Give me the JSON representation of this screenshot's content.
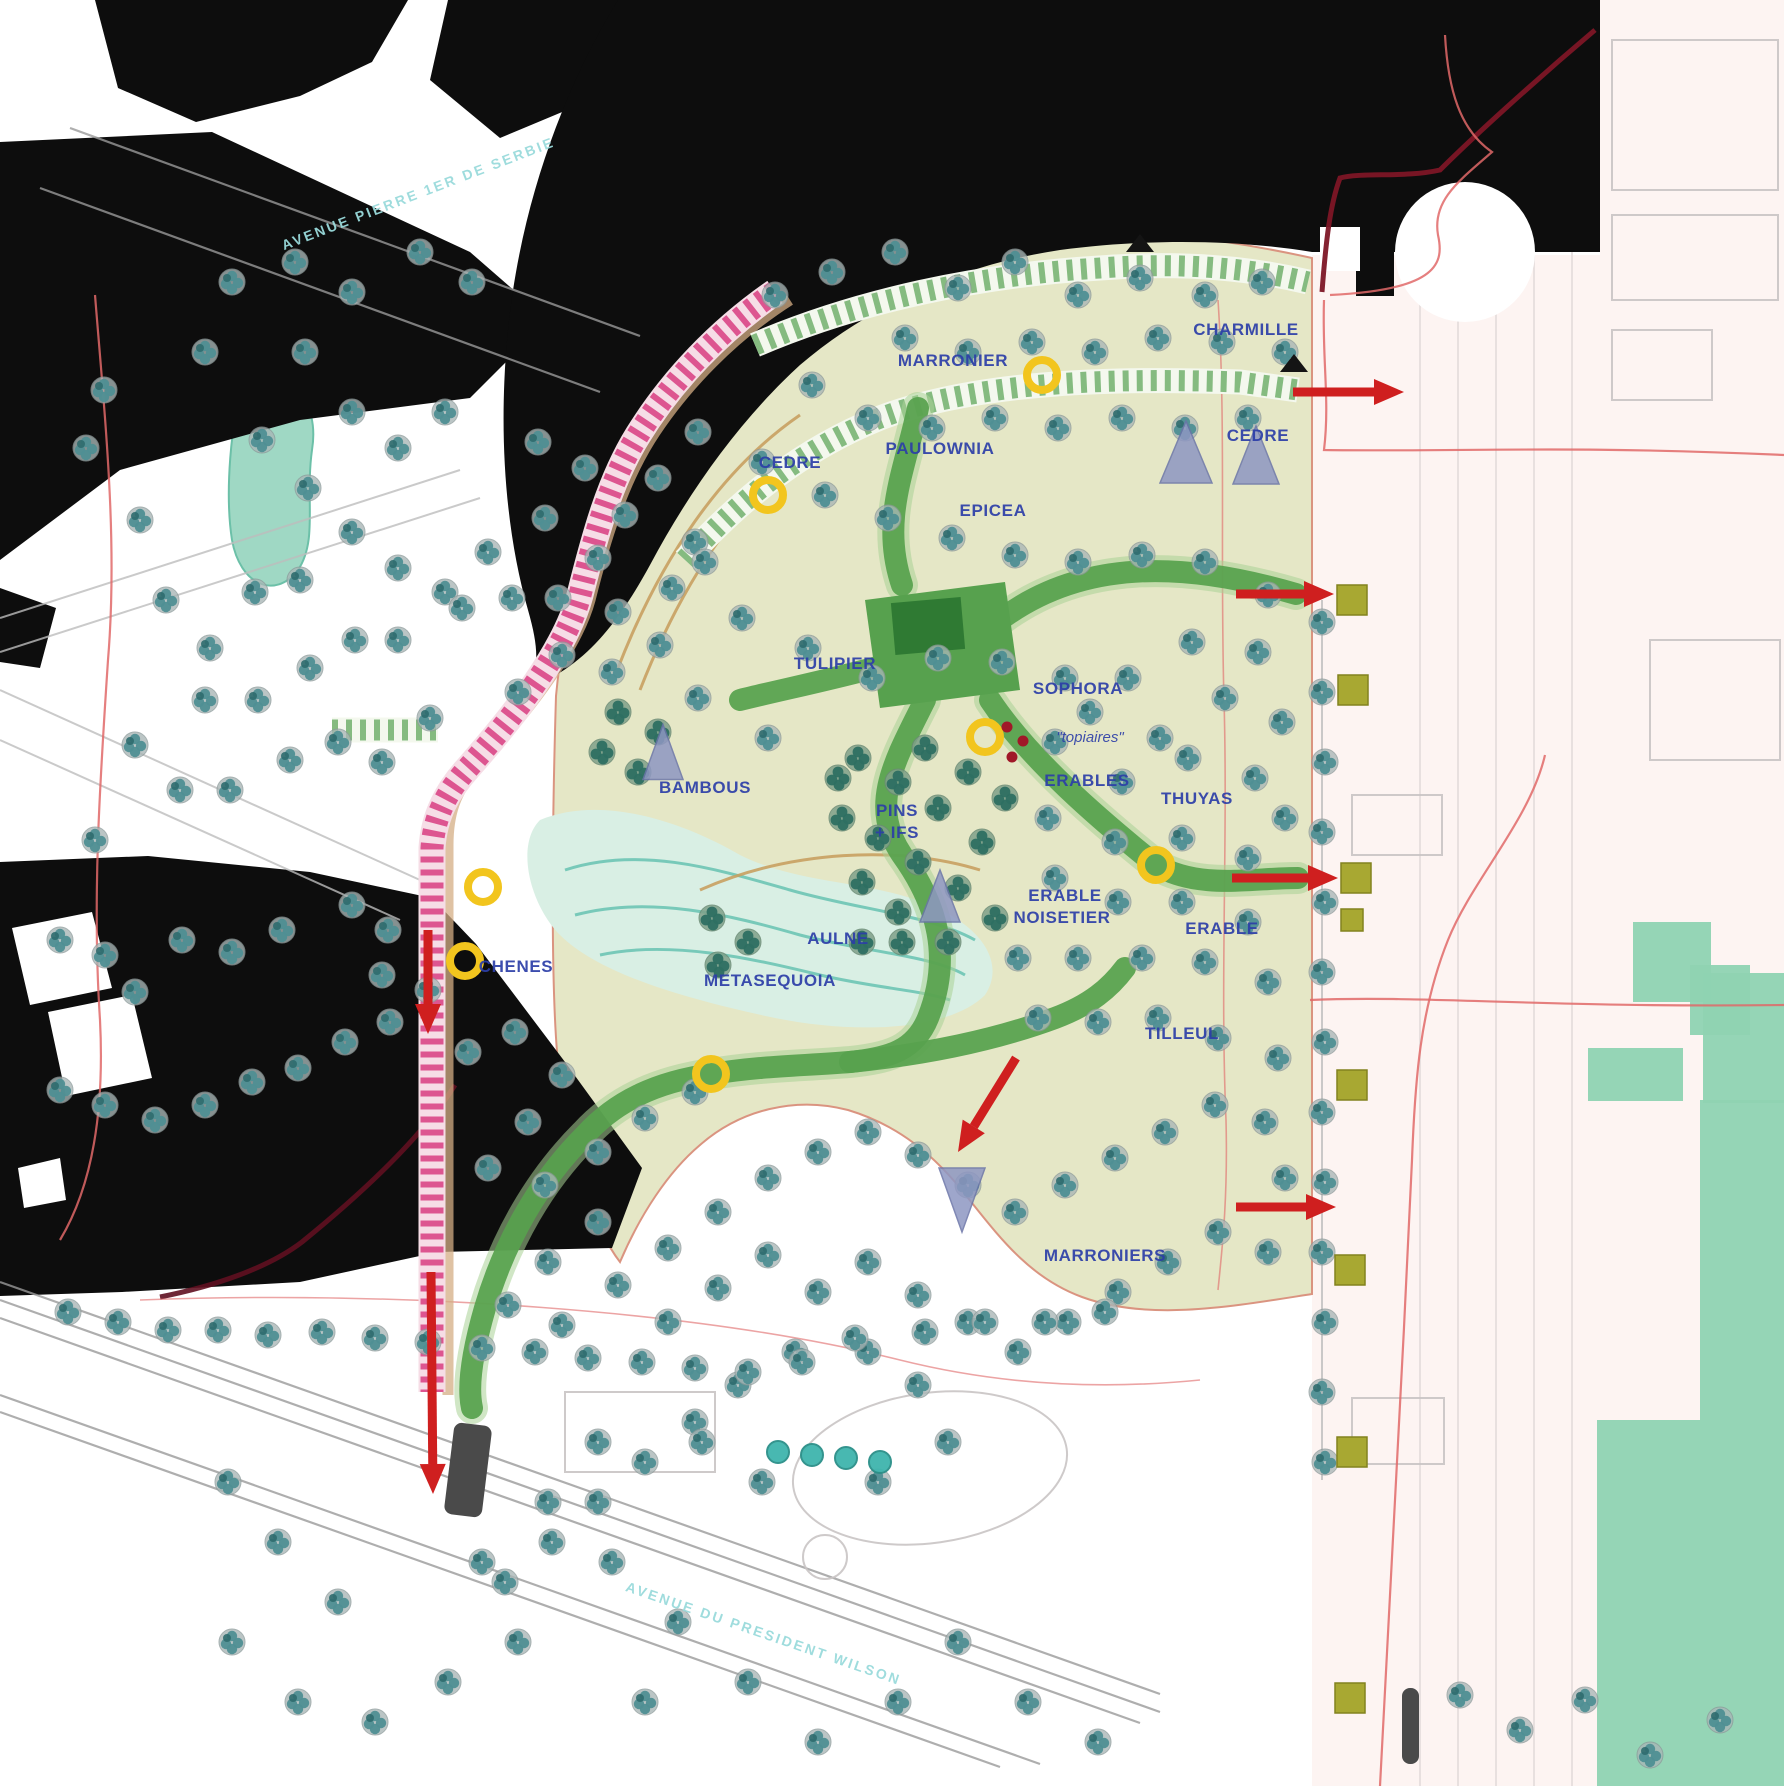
{
  "map_type": "landscape-masterplan",
  "colors": {
    "path_pink": "#dd5590",
    "hedge_green": "#85bb80",
    "walk_green": "#57a14e",
    "marker_yellow": "#f2c51e",
    "arrow_red": "#cf1f1f",
    "label_blue": "#2c3ea8",
    "street_cyan": "#9adbdc",
    "lawn_beige": "#e4e6c3",
    "block_teal": "#8fd3b2",
    "square_olive": "#a8a832",
    "building_black": "#0d0d0d"
  },
  "streets": [
    {
      "text": "AVENUE PIERRE 1ER DE SERBIE",
      "x": 420,
      "y": 198,
      "rot": -21
    },
    {
      "text": "AVENUE DU PRESIDENT WILSON",
      "x": 762,
      "y": 1638,
      "rot": 19
    }
  ],
  "plant_labels": [
    {
      "text": "MARRONIER",
      "x": 953,
      "y": 366
    },
    {
      "text": "CHARMILLE",
      "x": 1246,
      "y": 335
    },
    {
      "text": "PAULOWNIA",
      "x": 940,
      "y": 454
    },
    {
      "text": "CEDRE",
      "x": 790,
      "y": 468
    },
    {
      "text": "EPICEA",
      "x": 993,
      "y": 516
    },
    {
      "text": "CEDRE",
      "x": 1258,
      "y": 441
    },
    {
      "text": "TULIPIER",
      "x": 835,
      "y": 669
    },
    {
      "text": "SOPHORA",
      "x": 1078,
      "y": 694
    },
    {
      "text": "ERABLES",
      "x": 1087,
      "y": 786
    },
    {
      "text": "THUYAS",
      "x": 1197,
      "y": 804
    },
    {
      "text": "PINS",
      "x": 897,
      "y": 816
    },
    {
      "text": "+ IFS",
      "x": 897,
      "y": 838
    },
    {
      "text": "ERABLE",
      "x": 1065,
      "y": 901
    },
    {
      "text": "NOISETIER",
      "x": 1062,
      "y": 923
    },
    {
      "text": "ERABLE",
      "x": 1222,
      "y": 934
    },
    {
      "text": "AULNE",
      "x": 838,
      "y": 944
    },
    {
      "text": "METASEQUOIA",
      "x": 770,
      "y": 986
    },
    {
      "text": "TILLEUL",
      "x": 1182,
      "y": 1039
    },
    {
      "text": "BAMBOUS",
      "x": 705,
      "y": 793
    },
    {
      "text": "CHENES",
      "x": 516,
      "y": 972
    },
    {
      "text": "MARRONIERS",
      "x": 1105,
      "y": 1261
    }
  ],
  "annotations": [
    {
      "text": "\"topiaires\"",
      "x": 1090,
      "y": 742
    }
  ],
  "markers": {
    "yellow_circles": [
      [
        1042,
        375
      ],
      [
        768,
        495
      ],
      [
        985,
        737
      ],
      [
        1156,
        865
      ],
      [
        483,
        887
      ],
      [
        465,
        961
      ],
      [
        711,
        1074
      ]
    ],
    "red_dots": [
      [
        1007,
        727
      ],
      [
        1023,
        741
      ],
      [
        1012,
        757
      ]
    ],
    "red_arrows": [
      [
        1293,
        392,
        1404,
        392
      ],
      [
        1236,
        594,
        1334,
        594
      ],
      [
        1232,
        878,
        1338,
        878
      ],
      [
        1016,
        1058,
        958,
        1152
      ],
      [
        428,
        930,
        428,
        1034
      ],
      [
        431,
        1272,
        433,
        1494
      ],
      [
        1236,
        1207,
        1336,
        1207
      ]
    ],
    "black_triangles": [
      [
        1140,
        244
      ],
      [
        1294,
        364
      ]
    ],
    "gray_triangles": [
      [
        1186,
        452,
        52,
        62,
        0
      ],
      [
        1256,
        455,
        46,
        58,
        0
      ],
      [
        940,
        896,
        40,
        52,
        0
      ],
      [
        962,
        1200,
        46,
        64,
        180
      ],
      [
        663,
        752,
        40,
        55,
        0
      ]
    ],
    "olive_squares": [
      [
        1352,
        600,
        30
      ],
      [
        1353,
        690,
        30
      ],
      [
        1356,
        878,
        30
      ],
      [
        1352,
        920,
        22
      ],
      [
        1352,
        1085,
        30
      ],
      [
        1350,
        1270,
        30
      ],
      [
        1352,
        1452,
        30
      ],
      [
        1350,
        1698,
        30
      ]
    ],
    "dark_bars": [
      [
        449,
        1424,
        38,
        92,
        7
      ],
      [
        1402,
        1688,
        17,
        76,
        0
      ]
    ]
  },
  "trees": {
    "standard": [
      [
        232,
        282
      ],
      [
        295,
        262
      ],
      [
        352,
        292
      ],
      [
        420,
        252
      ],
      [
        472,
        282
      ],
      [
        205,
        352
      ],
      [
        104,
        390
      ],
      [
        86,
        448
      ],
      [
        140,
        520
      ],
      [
        166,
        600
      ],
      [
        210,
        648
      ],
      [
        262,
        440
      ],
      [
        305,
        352
      ],
      [
        352,
        412
      ],
      [
        398,
        448
      ],
      [
        445,
        412
      ],
      [
        308,
        488
      ],
      [
        352,
        532
      ],
      [
        398,
        568
      ],
      [
        300,
        580
      ],
      [
        255,
        592
      ],
      [
        205,
        700
      ],
      [
        258,
        700
      ],
      [
        310,
        668
      ],
      [
        355,
        640
      ],
      [
        398,
        640
      ],
      [
        445,
        592
      ],
      [
        488,
        552
      ],
      [
        135,
        745
      ],
      [
        180,
        790
      ],
      [
        230,
        790
      ],
      [
        95,
        840
      ],
      [
        290,
        760
      ],
      [
        338,
        742
      ],
      [
        382,
        762
      ],
      [
        430,
        718
      ],
      [
        60,
        940
      ],
      [
        105,
        955
      ],
      [
        388,
        930
      ],
      [
        352,
        905
      ],
      [
        282,
        930
      ],
      [
        232,
        952
      ],
      [
        182,
        940
      ],
      [
        135,
        992
      ],
      [
        382,
        975
      ],
      [
        428,
        990
      ],
      [
        60,
        1090
      ],
      [
        105,
        1105
      ],
      [
        155,
        1120
      ],
      [
        205,
        1105
      ],
      [
        252,
        1082
      ],
      [
        298,
        1068
      ],
      [
        345,
        1042
      ],
      [
        390,
        1022
      ],
      [
        538,
        442
      ],
      [
        585,
        468
      ],
      [
        625,
        515
      ],
      [
        598,
        558
      ],
      [
        558,
        598
      ],
      [
        618,
        612
      ],
      [
        672,
        588
      ],
      [
        695,
        542
      ],
      [
        658,
        478
      ],
      [
        698,
        432
      ],
      [
        545,
        518
      ],
      [
        512,
        598
      ],
      [
        562,
        655
      ],
      [
        612,
        672
      ],
      [
        660,
        645
      ],
      [
        518,
        692
      ],
      [
        462,
        608
      ],
      [
        775,
        295
      ],
      [
        832,
        272
      ],
      [
        895,
        252
      ],
      [
        958,
        288
      ],
      [
        1015,
        262
      ],
      [
        1078,
        295
      ],
      [
        1140,
        278
      ],
      [
        1205,
        295
      ],
      [
        1262,
        282
      ],
      [
        905,
        338
      ],
      [
        968,
        352
      ],
      [
        1032,
        342
      ],
      [
        1095,
        352
      ],
      [
        1158,
        338
      ],
      [
        1222,
        342
      ],
      [
        1285,
        352
      ],
      [
        812,
        385
      ],
      [
        868,
        418
      ],
      [
        932,
        428
      ],
      [
        995,
        418
      ],
      [
        1058,
        428
      ],
      [
        1122,
        418
      ],
      [
        1185,
        428
      ],
      [
        1248,
        418
      ],
      [
        762,
        462
      ],
      [
        825,
        495
      ],
      [
        888,
        518
      ],
      [
        952,
        538
      ],
      [
        1015,
        555
      ],
      [
        1078,
        562
      ],
      [
        1142,
        555
      ],
      [
        1205,
        562
      ],
      [
        1268,
        595
      ],
      [
        705,
        562
      ],
      [
        742,
        618
      ],
      [
        808,
        648
      ],
      [
        872,
        678
      ],
      [
        938,
        658
      ],
      [
        1002,
        662
      ],
      [
        1065,
        678
      ],
      [
        1128,
        678
      ],
      [
        1192,
        642
      ],
      [
        1258,
        652
      ],
      [
        698,
        698
      ],
      [
        768,
        738
      ],
      [
        1160,
        738
      ],
      [
        1225,
        698
      ],
      [
        1282,
        722
      ],
      [
        1090,
        712
      ],
      [
        1055,
        742
      ],
      [
        1122,
        782
      ],
      [
        1188,
        758
      ],
      [
        1255,
        778
      ],
      [
        1048,
        818
      ],
      [
        1115,
        842
      ],
      [
        1182,
        838
      ],
      [
        1248,
        858
      ],
      [
        1285,
        818
      ],
      [
        1055,
        878
      ],
      [
        1118,
        902
      ],
      [
        1182,
        902
      ],
      [
        1248,
        922
      ],
      [
        1018,
        958
      ],
      [
        1078,
        958
      ],
      [
        1142,
        958
      ],
      [
        1205,
        962
      ],
      [
        1268,
        982
      ],
      [
        1038,
        1018
      ],
      [
        1098,
        1022
      ],
      [
        1158,
        1018
      ],
      [
        1218,
        1038
      ],
      [
        1278,
        1058
      ],
      [
        468,
        1052
      ],
      [
        515,
        1032
      ],
      [
        562,
        1075
      ],
      [
        528,
        1122
      ],
      [
        488,
        1168
      ],
      [
        545,
        1185
      ],
      [
        598,
        1152
      ],
      [
        645,
        1118
      ],
      [
        695,
        1092
      ],
      [
        598,
        1222
      ],
      [
        548,
        1262
      ],
      [
        508,
        1305
      ],
      [
        562,
        1325
      ],
      [
        618,
        1285
      ],
      [
        668,
        1248
      ],
      [
        718,
        1212
      ],
      [
        768,
        1178
      ],
      [
        818,
        1152
      ],
      [
        868,
        1132
      ],
      [
        918,
        1155
      ],
      [
        968,
        1185
      ],
      [
        1015,
        1212
      ],
      [
        1065,
        1185
      ],
      [
        1115,
        1158
      ],
      [
        1165,
        1132
      ],
      [
        1215,
        1105
      ],
      [
        1265,
        1122
      ],
      [
        1285,
        1178
      ],
      [
        668,
        1322
      ],
      [
        718,
        1288
      ],
      [
        768,
        1255
      ],
      [
        818,
        1292
      ],
      [
        868,
        1262
      ],
      [
        918,
        1295
      ],
      [
        968,
        1322
      ],
      [
        1018,
        1352
      ],
      [
        1068,
        1322
      ],
      [
        1118,
        1292
      ],
      [
        1168,
        1262
      ],
      [
        1218,
        1232
      ],
      [
        1268,
        1252
      ],
      [
        868,
        1352
      ],
      [
        918,
        1385
      ],
      [
        795,
        1352
      ],
      [
        738,
        1385
      ],
      [
        695,
        1422
      ],
      [
        645,
        1462
      ],
      [
        598,
        1502
      ],
      [
        552,
        1542
      ],
      [
        505,
        1582
      ],
      [
        1322,
        622
      ],
      [
        1322,
        692
      ],
      [
        1325,
        762
      ],
      [
        1322,
        832
      ],
      [
        1325,
        902
      ],
      [
        1322,
        972
      ],
      [
        1325,
        1042
      ],
      [
        1322,
        1112
      ],
      [
        1325,
        1182
      ],
      [
        1322,
        1252
      ],
      [
        1325,
        1322
      ],
      [
        1322,
        1392
      ],
      [
        1325,
        1462
      ],
      [
        68,
        1312
      ],
      [
        118,
        1322
      ],
      [
        168,
        1330
      ],
      [
        218,
        1330
      ],
      [
        268,
        1335
      ],
      [
        322,
        1332
      ],
      [
        375,
        1338
      ],
      [
        428,
        1342
      ],
      [
        482,
        1348
      ],
      [
        535,
        1352
      ],
      [
        588,
        1358
      ],
      [
        642,
        1362
      ],
      [
        695,
        1368
      ],
      [
        748,
        1372
      ],
      [
        802,
        1362
      ],
      [
        855,
        1338
      ],
      [
        925,
        1332
      ],
      [
        985,
        1322
      ],
      [
        1045,
        1322
      ],
      [
        1105,
        1312
      ],
      [
        228,
        1482
      ],
      [
        278,
        1542
      ],
      [
        338,
        1602
      ],
      [
        232,
        1642
      ],
      [
        298,
        1702
      ],
      [
        375,
        1722
      ],
      [
        448,
        1682
      ],
      [
        518,
        1642
      ],
      [
        482,
        1562
      ],
      [
        548,
        1502
      ],
      [
        612,
        1562
      ],
      [
        678,
        1622
      ],
      [
        748,
        1682
      ],
      [
        818,
        1742
      ],
      [
        645,
        1702
      ],
      [
        898,
        1702
      ],
      [
        958,
        1642
      ],
      [
        1028,
        1702
      ],
      [
        1098,
        1742
      ],
      [
        878,
        1482
      ],
      [
        948,
        1442
      ],
      [
        702,
        1442
      ],
      [
        762,
        1482
      ],
      [
        598,
        1442
      ],
      [
        1460,
        1695
      ],
      [
        1520,
        1730
      ],
      [
        1585,
        1700
      ],
      [
        1650,
        1755
      ],
      [
        1720,
        1720
      ]
    ],
    "dense": [
      [
        858,
        758
      ],
      [
        898,
        782
      ],
      [
        938,
        808
      ],
      [
        878,
        838
      ],
      [
        918,
        862
      ],
      [
        958,
        888
      ],
      [
        898,
        912
      ],
      [
        862,
        882
      ],
      [
        842,
        818
      ],
      [
        982,
        842
      ],
      [
        995,
        918
      ],
      [
        948,
        942
      ],
      [
        902,
        942
      ],
      [
        862,
        942
      ],
      [
        925,
        748
      ],
      [
        968,
        772
      ],
      [
        1005,
        798
      ],
      [
        838,
        778
      ],
      [
        618,
        712
      ],
      [
        658,
        732
      ],
      [
        638,
        772
      ],
      [
        602,
        752
      ],
      [
        712,
        918
      ],
      [
        748,
        942
      ],
      [
        718,
        965
      ]
    ],
    "teal": [
      [
        778,
        1452
      ],
      [
        812,
        1455
      ],
      [
        846,
        1458
      ],
      [
        880,
        1462
      ]
    ]
  }
}
